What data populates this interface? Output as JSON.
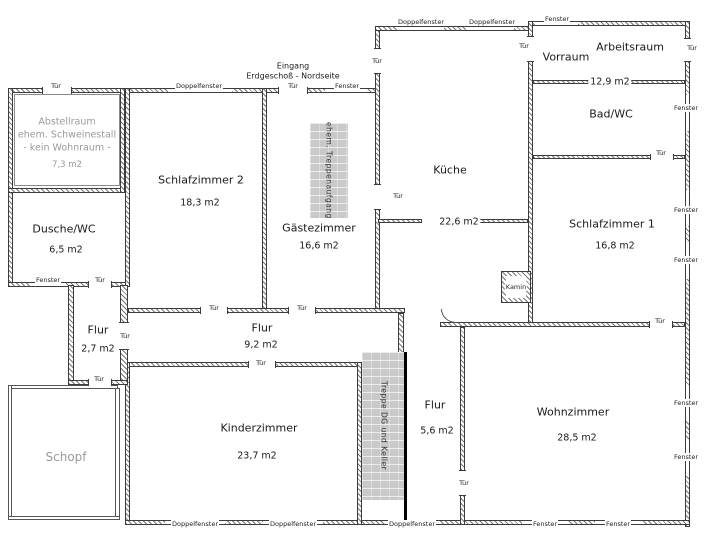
{
  "glossary": {
    "tuer": "Tür",
    "fenster": "Fenster",
    "doppelfenster": "Doppelfenster"
  },
  "annotations": {
    "eingang_line1": "Eingang",
    "eingang_line2": "Erdgeschoß - Nordseite",
    "kamin": "Kamin",
    "treppenaufgang": "ehem. Treppenaufgang",
    "treppe_dg": "Treppe DG und Keller"
  },
  "rooms": {
    "abstellraum": {
      "name": "Abstellraum",
      "line2": "ehem. Schweinestall",
      "line3": "- kein Wohnraum -",
      "area": "7,3 m2"
    },
    "dusche": {
      "name": "Dusche/WC",
      "area": "6,5 m2"
    },
    "schlafzimmer2": {
      "name": "Schlafzimmer 2",
      "area": "18,3 m2"
    },
    "gaestezimmer": {
      "name": "Gästezimmer",
      "area": "16,6 m2"
    },
    "kueche": {
      "name": "Küche",
      "area": "22,6 m2"
    },
    "vorraum": {
      "name": "Vorraum"
    },
    "arbeitsraum": {
      "name": "Arbeitsraum",
      "area": "12,9 m2"
    },
    "bad": {
      "name": "Bad/WC"
    },
    "schlafzimmer1": {
      "name": "Schlafzimmer 1",
      "area": "16,8 m2"
    },
    "flur_klein": {
      "name": "Flur",
      "area": "2,7 m2"
    },
    "flur_mitte": {
      "name": "Flur",
      "area": "9,2 m2"
    },
    "kinderzimmer": {
      "name": "Kinderzimmer",
      "area": "23,7 m2"
    },
    "schopf": {
      "name": "Schopf"
    },
    "flur_sued": {
      "name": "Flur",
      "area": "5,6 m2"
    },
    "wohnzimmer": {
      "name": "Wohnzimmer",
      "area": "28,5 m2"
    }
  },
  "colors": {
    "wall_line": "#3c3c3c",
    "stair_fill": "#c9c9c9",
    "muted_text": "#9a9a9a"
  }
}
